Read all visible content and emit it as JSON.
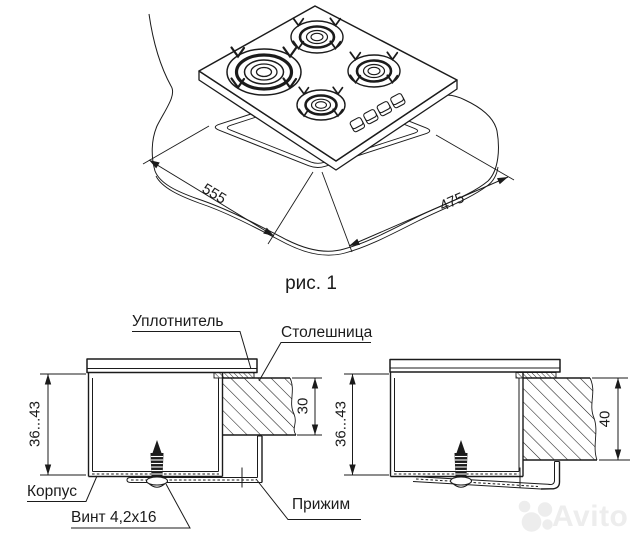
{
  "figure1": {
    "caption": "рис. 1",
    "cutout_width": "555",
    "cutout_depth": "475"
  },
  "sections": {
    "left": {
      "height_range": "36...43",
      "countertop_thickness": "30"
    },
    "right": {
      "height_range": "36...43",
      "countertop_thickness": "40"
    }
  },
  "labels": {
    "seal": "Уплотнитель",
    "countertop": "Столешница",
    "body": "Корпус",
    "screw": "Винт 4,2х16",
    "clamp": "Прижим"
  },
  "watermark": {
    "text": "Avito",
    "color": "#ededed"
  },
  "colors": {
    "line": "#1b1b1b",
    "background": "#ffffff"
  }
}
